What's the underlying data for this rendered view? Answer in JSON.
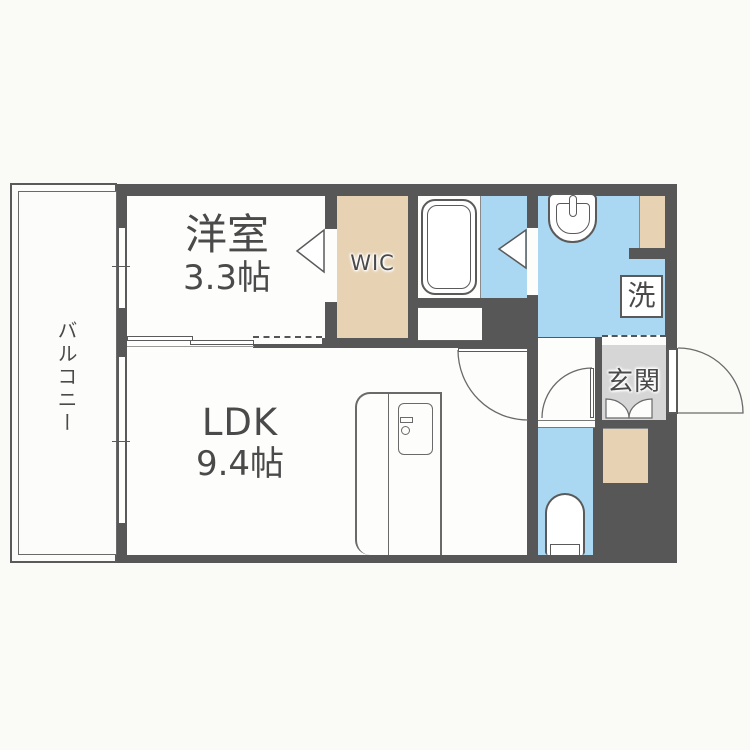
{
  "floorplan": {
    "rooms": {
      "western_room": {
        "label": "洋室",
        "size": "3.3帖"
      },
      "ldk": {
        "label": "LDK",
        "size": "9.4帖"
      },
      "wic": {
        "label": "WIC"
      },
      "balcony": {
        "label": "バルコニー"
      },
      "entrance": {
        "label": "玄関"
      },
      "laundry": {
        "label": "洗"
      }
    },
    "colors": {
      "wall": "#575757",
      "water_area_floor": "#aad8f2",
      "storage_floor": "#e7d3b4",
      "entrance_floor": "#d6d6d6",
      "room_floor": "#fdfdfb",
      "background": "#fafaf7",
      "text": "#4a4a4a"
    }
  }
}
